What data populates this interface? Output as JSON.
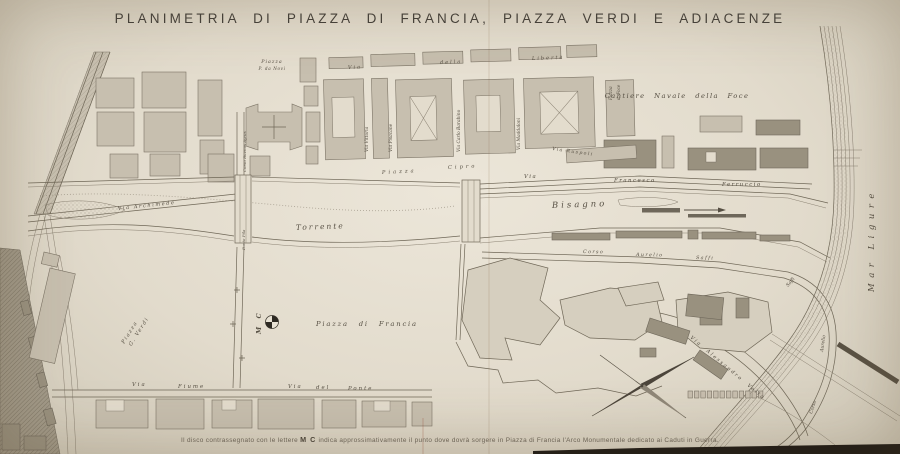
{
  "title": "PLANIMETRIA DI PIAZZA DI FRANCIA, PIAZZA VERDI E ADIACENZE",
  "caption": {
    "pre": "Il disco contrassegnato con le lettere",
    "mc": "M C",
    "post": "indica approssimativamente il punto dove dovrà sorgere in Piazza di Francia l'Arco Monumentale dedicato ai Caduti in Guerra."
  },
  "labels": {
    "piazza_novi": [
      "Piazza",
      "P. da Novi"
    ],
    "via_liberta": [
      "Via",
      "della",
      "Libertà"
    ],
    "piazza_foce": [
      "Piazza",
      "d. Foce"
    ],
    "cantiere": "Cantiere Navale della Foce",
    "via_vittoria": "Via Vittoria",
    "via_pisacane": "Via Pisacane",
    "via_barabino": "Via Carlo Barabino",
    "via_maddaloni": "Via Maddaloni",
    "corso_buenos": "Corso Buenos Ayres",
    "ponte_pila": "Ponte Pila",
    "via_archimede": "Via Archimede",
    "piazza_cipro": [
      "Piazza",
      "Cipro"
    ],
    "torrente": "Torrente",
    "bisagno": "Bisagno",
    "via_ferruccio": [
      "Via",
      "Francesco",
      "Ferruccio"
    ],
    "via_ruspoli": "Via Ruspoli",
    "corso_saffi": [
      "Corso",
      "Aurelio",
      "Saffi"
    ],
    "saffi_curve": [
      "Saffi",
      "Aurelio",
      "Corso"
    ],
    "via_volta": "Via Alessandro Volta",
    "mar_ligure": "Mar  Ligure",
    "piazza_francia": "Piazza  di  Francia",
    "mc_mark": "M C",
    "piazza_verdi": [
      "Piazza",
      "G. Verdi"
    ],
    "via_fiume": [
      "Via",
      "Fiume"
    ],
    "via_ponte": [
      "Via",
      "del",
      "Ponte"
    ]
  },
  "colors": {
    "paper": "#e2dbcc",
    "ink": "#564f43",
    "photo_shadow": "#1e1a15"
  }
}
